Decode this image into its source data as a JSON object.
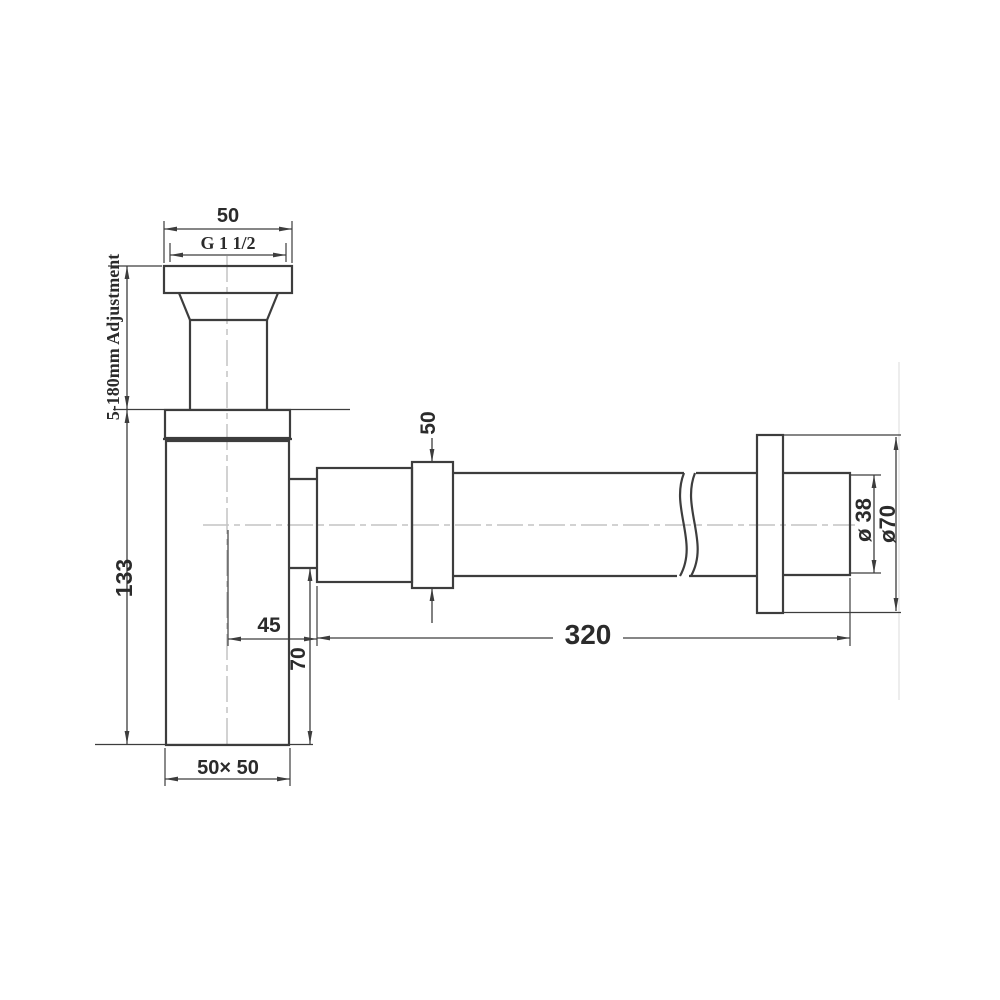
{
  "drawing": {
    "type": "technical-dimension-drawing",
    "subject": "bottle trap with wall outlet pipe",
    "colors": {
      "line": "#3d3d3d",
      "centerline": "#c3c3c3",
      "background": "#ffffff"
    },
    "labels": {
      "top_width": "50",
      "thread_size": "G 1 1/2",
      "adjustment": "5-180mm Adjustment",
      "body_height": "133",
      "centre_offset": "45",
      "outlet_height": "70",
      "pipe_length": "320",
      "outlet_nut": "50",
      "body_base": "50× 50",
      "pipe_diameter": "ø 38",
      "flange_diameter": "ø70"
    }
  }
}
